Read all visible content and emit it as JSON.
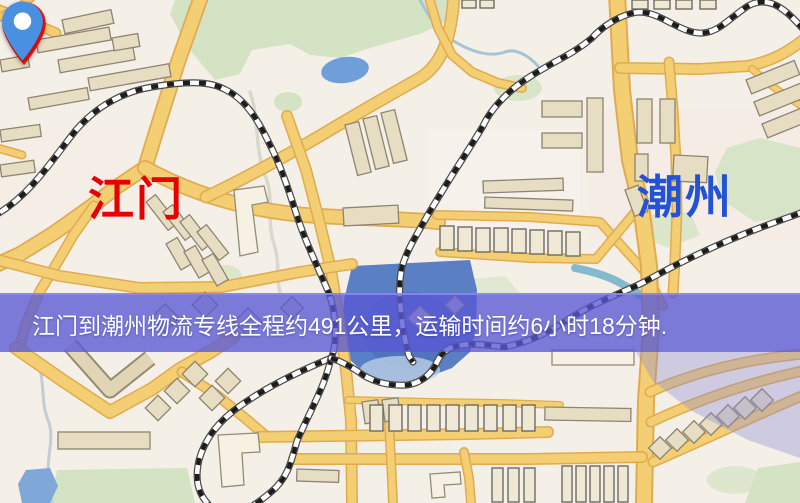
{
  "map": {
    "markers": {
      "origin": {
        "label": "江门",
        "pin_color": "#e8100c",
        "label_color": "#e60000",
        "pin_icon": "location-pin-icon"
      },
      "destination": {
        "label": "潮州",
        "pin_color": "#4a90e2",
        "label_color": "#2353d4",
        "pin_icon": "location-pin-icon"
      }
    },
    "banner": {
      "text": "江门到潮州物流专线全程约491公里，运输时间约6小时18分钟.",
      "distance_text": "约491公里",
      "duration_text": "约6小时18分钟",
      "distance_km": 491,
      "text_color": "#ffffff",
      "background_color": "#5858d5"
    },
    "colors": {
      "map_background": "#f5f0e7",
      "road_fill": "#f4ce72",
      "road_casing": "#e0ab50",
      "building": "#e7ddc2",
      "park": "#d4e3c3",
      "pond": "#6f9fd8",
      "lake": "#5b7fc4",
      "railway_dark": "#1d1d1d"
    }
  }
}
